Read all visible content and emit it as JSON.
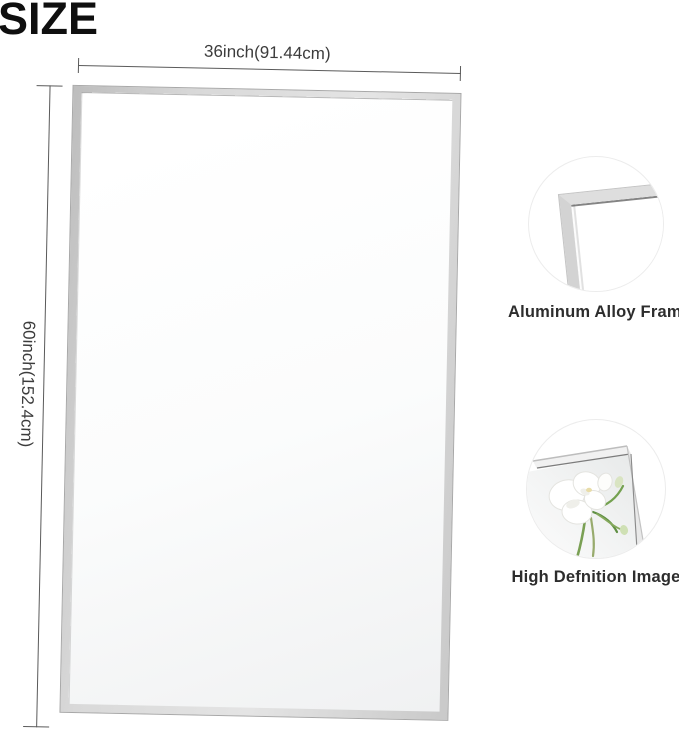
{
  "title": {
    "text": "SIZE"
  },
  "diagram": {
    "subject": "rectangular wall mirror with silver aluminum frame",
    "width_label": "36inch(91.44cm)",
    "height_label": "60inch(152.4cm)",
    "width_inches": 36,
    "width_cm": 91.44,
    "height_inches": 60,
    "height_cm": 152.4
  },
  "details": [
    {
      "caption": "Aluminum Alloy Frame",
      "image": "frame-corner-closeup"
    },
    {
      "caption": "High Defnition Image",
      "image": "mirror-corner-with-white-freesia-flowers"
    }
  ],
  "colors": {
    "background": "#ffffff",
    "title_text": "#0f0f0f",
    "dimension_line": "#5a5a5a",
    "dimension_text": "#3c3c3c",
    "caption_text": "#2d2d2d",
    "frame_silver": "#d9d9d9",
    "frame_edge": "#a8a8a8",
    "stem_green": "#6b9d4a"
  }
}
